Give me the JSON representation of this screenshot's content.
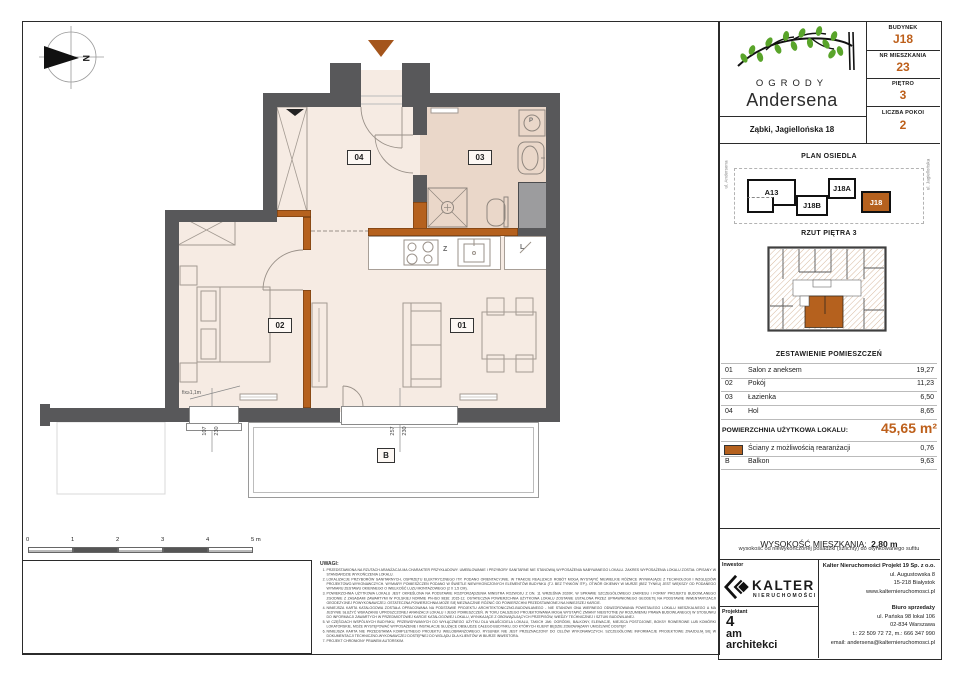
{
  "header": {
    "logo_top": "OGRODY",
    "logo_bottom": "Andersena",
    "address": "Ząbki, Jagiellońska 18",
    "fields": [
      {
        "label": "BUDYNEK",
        "value": "J18"
      },
      {
        "label": "NR MIESZKANIA",
        "value": "23"
      },
      {
        "label": "PIĘTRO",
        "value": "3"
      },
      {
        "label": "LICZBA POKOI",
        "value": "2"
      }
    ]
  },
  "site_plan": {
    "title": "PLAN OSIEDLA",
    "buildings": [
      {
        "label": "A13",
        "highlighted": false
      },
      {
        "label": "J18B",
        "highlighted": false
      },
      {
        "label": "J18A",
        "highlighted": false
      },
      {
        "label": "J18",
        "highlighted": true
      }
    ],
    "street_left": "ul. Andersena",
    "street_right": "ul. Jagiellońska"
  },
  "floor_plan_thumb": {
    "title": "RZUT PIĘTRA 3"
  },
  "rooms_table": {
    "title": "ZESTAWIENIE POMIESZCZEŃ",
    "rows": [
      {
        "no": "01",
        "name": "Salon z aneksem",
        "area": "19,27"
      },
      {
        "no": "02",
        "name": "Pokój",
        "area": "11,23"
      },
      {
        "no": "03",
        "name": "Łazienka",
        "area": "6,50"
      },
      {
        "no": "04",
        "name": "Hol",
        "area": "8,65"
      }
    ],
    "total_label": "POWIERZCHNIA UŻYTKOWA LOKALU:",
    "total_value": "45,65 m²",
    "reconfig_row": {
      "name": "Ściany z możliwością rearanżacji",
      "area": "0,76"
    },
    "balcony_row": {
      "no": "B",
      "name": "Balkon",
      "area": "9,63"
    }
  },
  "height_info": {
    "label": "WYSOKOŚĆ MIESZKANIA:",
    "value": "2,80 m",
    "note": "wysokość od niewykończonej posadzki (szlichty) do otynkowanego sufitu"
  },
  "companies": {
    "investor_label": "Inwestor",
    "investor_name": "KALTER",
    "investor_sub": "nieruchomości",
    "designer_label": "Projektant",
    "designer_l1": "4",
    "designer_l2": "am",
    "designer_l3": "architekci",
    "company_name": "Kalter Nieruchomości Projekt 19 Sp. z o.o.",
    "company_addr1": "ul. Augustowska 8",
    "company_addr2": "15-218 Białystok",
    "company_www": "www.kalternieruchomosci.pl",
    "sales_label": "Biuro sprzedaży",
    "sales_addr1": "ul. Pańska 98 lokal 106",
    "sales_addr2": "02-834 Warszawa",
    "sales_phone": "t.: 22 509 72 72, m.: 666 347 990",
    "sales_email": "email: andersena@kalternieruchomosci.pl"
  },
  "legend": {
    "title": "LEGENDA",
    "item1": "Ściany z możliwością rearanżacji",
    "item2": "Ściany nierozbieralne",
    "item3": "Powierzchnia szachtów instalacyjnych",
    "item4": "Tablica mieszkaniowa",
    "item5": "Wymiar zestawu okiennego",
    "item6": "Grzejnik c.o.",
    "item7": "Grzejnik łazienkowy"
  },
  "scale_bar": {
    "ticks": [
      "0",
      "1",
      "2",
      "3",
      "4",
      "5 m"
    ]
  },
  "plan": {
    "labels": {
      "living": "01",
      "bedroom": "02",
      "bathroom": "03",
      "hall": "04",
      "balcony": "B",
      "sink": "Z",
      "fridge": "L",
      "washer": "P",
      "north": "N"
    },
    "dims": {
      "win_left_w": "107",
      "win_left_h": "230",
      "win_right_w": "257",
      "win_right_h": "230",
      "fix_note": "fix≥1,1m"
    }
  },
  "notes": {
    "title": "UWAGI:",
    "items": [
      "PRZEDSTAWIONA NA RZUTACH ARANŻACJA MA CHARAKTER PRZYKŁADOWY. UMEBLOWANIE I PRZYBORY SANITARNE NIE STANOWIĄ WYPOSAŻENIA NABYWANEGO LOKALU. ZAKRES WYPOSAŻENIA LOKALU ZOSTAŁ OPISANY W STANDARDZIE WYKOŃCZENIA LOKALU.",
      "LOKALIZACJE PRZYBORÓW SANITARNYCH, OSPRZĘTU ELEKTRYCZNEGO ITP. PODANO ORIENTACYJNIE. W TRAKCIE REALIZACJI ROBÓT MOGĄ WYSTĄPIĆ NIEWIELKIE RÓŻNICE WYNIKAJĄCE Z TECHNOLOGII I WZGLĘDÓW PROJEKTOWO-WYKONAWCZYCH. WYMIARY POMIESZCZEŃ PODANO W ŚWIETLE NIEWYKOŃCZONYCH ELEMENTÓW BUDYNKU (TJ. BEZ TYNKÓW ITP.). OTWÓR OKIENNY W MURZE (BEZ TYNKU) JEST WIĘKSZY OD PODANEGO WYMIARU ZESTAWU OKIENNEGO O WIELKOŚĆ LUZU MONTAŻOWEGO (2 X 1,5 CM).",
      "POWIERZCHNIA UŻYTKOWA LOKALU JEST OKREŚLONA NA PODSTAWIE ROZPORZĄDZENIA MINISTRA ROZWOJU Z DN. 11 WRZEŚNIA 2020R. W SPRAWIE SZCZEGÓŁOWEGO ZAKRESU I FORMY PROJEKTU BUDOWLANEGO ZGODNIE Z ZASADAMI ZAWARTYMI W POLSKIEJ NORMIE PN-ISO 9836: 2015-12. OSTATECZNA POWIERZCHNIA UŻYTKOWA LOKALU ZOSTANIE USTALONA PRZEZ UPRAWNIONEGO GEODETĘ NA PODSTAWIE INWENTARYZACJI GEODEZYJNEJ POWYKONAWCZEJ. OSTATECZNA POWIERZCHNIA MOŻE SIĘ NIEZNACZNIE RÓŻNIĆ OD POWIERZCHNI PRZEDSTAWIONEJ NA NINIEJSZEJ KARCIE.",
      "NINIEJSZA KARTA KATALOGOWA ZOSTAŁA OPRACOWANA NA PODSTAWIE PROJEKTU ARCHITEKTONICZNO-BUDOWLANEGO - NIE STANOWI ONA WIERNEGO ODWZOROWANIA POWSTAŁEGO LOKALU MIESZKALNEGO A MA JEDYNIE SŁUŻYĆ WSKAZANIU UPROSZCZONEJ ARANŻACJI LOKALU I JEGO POMIESZCZEŃ. W TOKU DALSZEGO PROJEKTOWANIA MOGĄ WYSTĄPIĆ ZMIANY NIEISTOTNE (W ROZUMIENIU PRAWA BUDOWLANEGO) W STOSUNKU DO INFORMACJI ZAWARTYCH W PRZEDMIOTOWEJ KARCIE KATALOGOWEJ LOKALU, WYNIKAJĄCE Z OBOWIĄZUJĄCYCH PRZEPISÓW, WIEDZY TECHNICZNEJ I SZTUKI BUDOWLANEJ.",
      "W CZĘŚCIACH WSPÓLNYCH BUDYNKU, PRZEWIDYWANYCH DO WYŁĄCZNEGO UŻYTKU DLA WŁAŚCICIELA LOKALU, TAKICH JAK: OGRÓDKI, BALKONY, ELEWACJE, MIEJSCA POSTOJOWE, BOKSY ROWEROWE LUB KOMÓRKI LOKATORSKIE, MOŻE WYSTĘPOWAĆ WYPOSAŻENIE I INSTALACJE SŁUŻĄCE OBSŁUDZE CAŁEGO BUDYNKU, DO KTÓRYCH KLIENT BĘDZIE ZOBOWIĄZANY UMOŻLIWIĆ DOSTĘP.",
      "NINIEJSZA KARTA NIE PRZEDSTAWIA KOMPLETNEGO PROJEKTU WIELOBRANŻOWEGO. RYSUNEK NIE JEST PRZEZNACZONY DO CELÓW WYKONAWCZYCH. SZCZEGÓŁOWE INFORMACJE PROJEKTOWE ZNAJDUJĄ SIĘ W DOKUMENTACJI TECHNICZNO-WYKONAWCZEJ DOSTĘPNEJ DO WGLĄDU DLA KLIENTÓW W BIURZE INWESTORA.",
      "PROJEKT CHRONIONY PRAWEM AUTORSKIM."
    ]
  },
  "colors": {
    "accent": "#bd5f1a",
    "wall": "#58585a",
    "reconfig_wall": "#b5611e",
    "shaft": "#9c9c9e"
  }
}
